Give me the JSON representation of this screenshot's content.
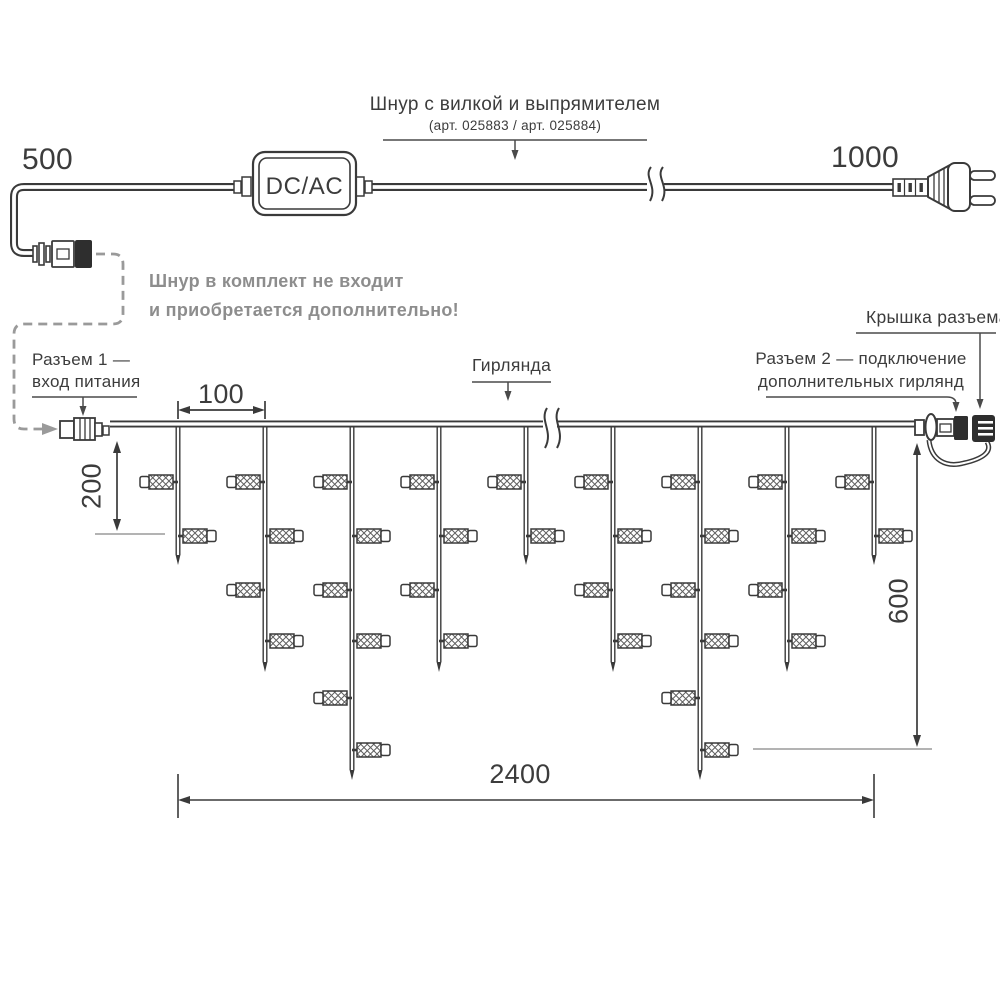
{
  "diagram": {
    "power_cord": {
      "label_title": "Шнур с вилкой и выпрямителем",
      "label_articles": "(арт. 025883 / арт. 025884)",
      "adapter": "DC/AC",
      "dim_cord_left": "500",
      "dim_cord_right": "1000",
      "note_line1": "Шнур в комплект не входит",
      "note_line2": "и приобретается дополнительно!"
    },
    "garland": {
      "connector1_line1": "Разъем 1 —",
      "connector1_line2": "вход питания",
      "garland_label": "Гирлянда",
      "cap_label": "Крышка разъема",
      "connector2_line1": "Разъем 2 — подключение",
      "connector2_line2": "дополнительных гирлянд",
      "dim_drop_spacing": "100",
      "dim_short_drop": "200",
      "dim_long_drop": "600",
      "dim_total_length": "2400",
      "drops": [
        {
          "bulbs": 2
        },
        {
          "bulbs": 4
        },
        {
          "bulbs": 6
        },
        {
          "bulbs": 4
        },
        {
          "bulbs": 2
        },
        {
          "bulbs": 4
        },
        {
          "bulbs": 6
        },
        {
          "bulbs": 4
        },
        {
          "bulbs": 2
        }
      ]
    },
    "colors": {
      "line": "#3a3a3a",
      "note_gray": "#8d8d8d",
      "dash_gray": "#9a9a9a"
    }
  }
}
